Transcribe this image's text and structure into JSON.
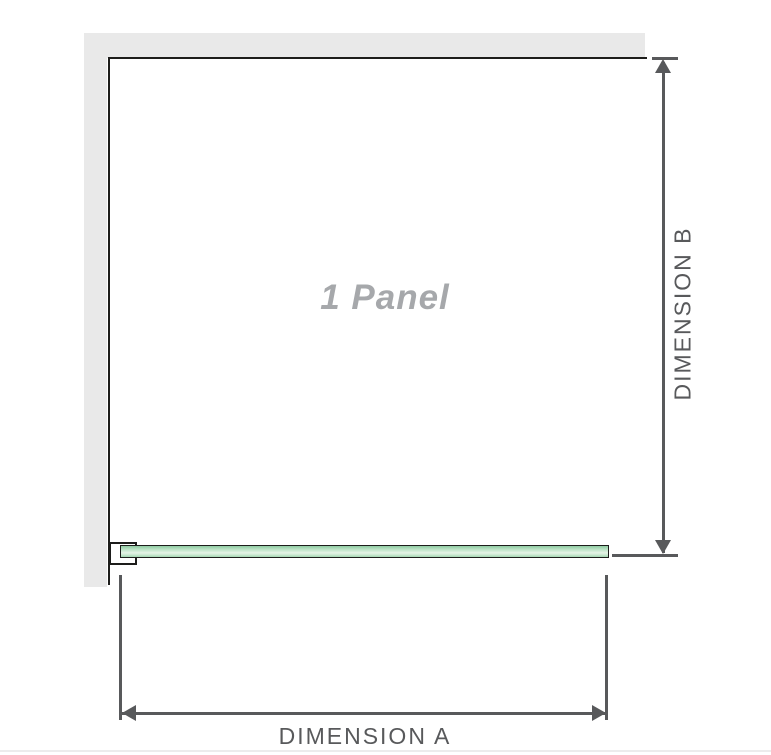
{
  "diagram": {
    "panel_label": "1 Panel",
    "dimension_a_label": "DIMENSION A",
    "dimension_b_label": "DIMENSION B"
  },
  "colors": {
    "wall_fill": "#e9e9e9",
    "outline": "#1d1d1b",
    "dimension": "#58595b",
    "panel_text": "#a6a8ab",
    "glass_top": "#8fcba2",
    "glass_mid": "#e5f3e6",
    "glass_bottom": "#a4d7b2",
    "divider": "#ececec"
  }
}
